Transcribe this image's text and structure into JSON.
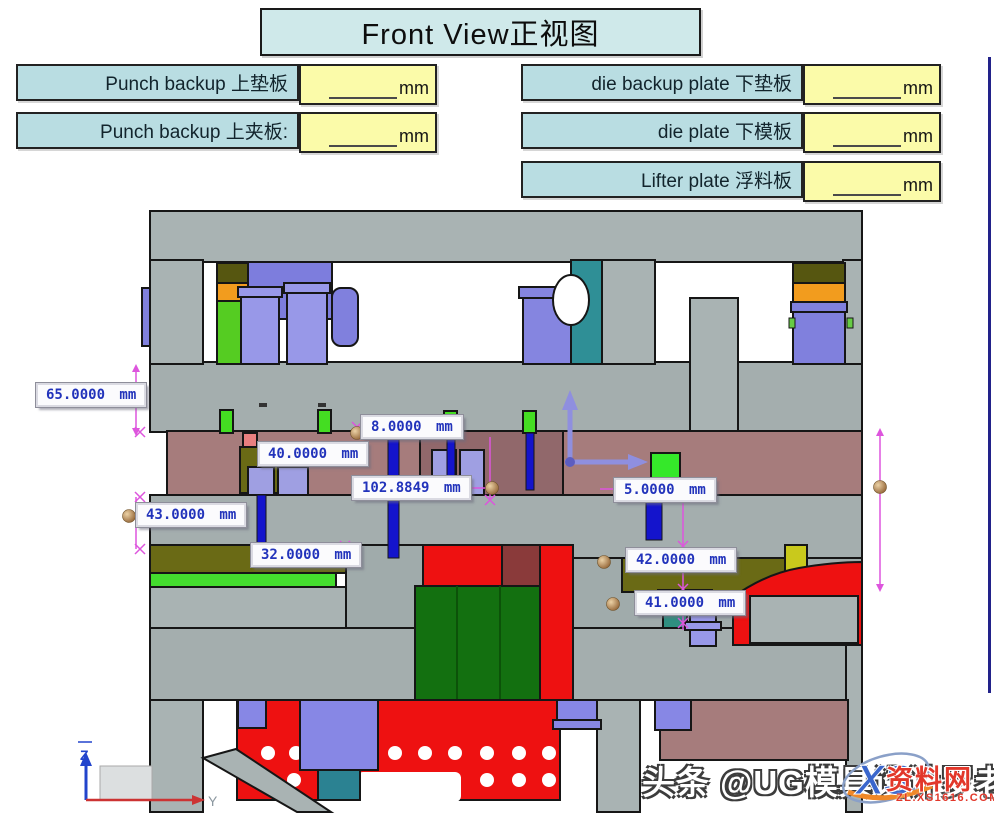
{
  "title": "Front View正视图",
  "plate_form": {
    "left": [
      {
        "label": "Punch backup 上垫板",
        "value": "",
        "unit": "mm"
      },
      {
        "label": "Punch backup 上夹板:",
        "value": "",
        "unit": "mm"
      }
    ],
    "right": [
      {
        "label": "die backup plate 下垫板",
        "value": "",
        "unit": "mm"
      },
      {
        "label": "die plate 下模板",
        "value": "",
        "unit": "mm"
      },
      {
        "label": "Lifter plate 浮料板",
        "value": "",
        "unit": "mm"
      }
    ]
  },
  "cad_view": {
    "dimensions": [
      {
        "name": "punch-backup-plate",
        "text": "65.0000 mm"
      },
      {
        "name": "insert-step",
        "text": "8.0000 mm"
      },
      {
        "name": "punch-holder-plate",
        "text": "40.0000 mm"
      },
      {
        "name": "open-height",
        "text": "102.8849 mm"
      },
      {
        "name": "clearance",
        "text": "5.0000 mm"
      },
      {
        "name": "stripper-plate",
        "text": "43.0000 mm"
      },
      {
        "name": "die-plate",
        "text": "32.0000 mm"
      },
      {
        "name": "die-backup-plate",
        "text": "42.0000 mm"
      },
      {
        "name": "lifter-plate",
        "text": "41.0000 mm"
      }
    ],
    "triad": {
      "z_label": "Z",
      "y_label": "Y"
    }
  },
  "watermark": {
    "text": "头条 @UG模具设计罗老师"
  },
  "logo": {
    "monogram": "XS",
    "site_name": "资料网",
    "site_url": "ZL.XS1616.COM"
  },
  "colors": {
    "title_bg": "#cfe9ea",
    "label_bg": "#b9dde2",
    "value_bg": "#fbfba9",
    "dim_text_blue": "#2233bb",
    "dim_line_magenta": "#dd55dd",
    "cad_gray": "#a9b3b3",
    "mauve_plate": "#a67c7c",
    "olive_plate": "#6a6a15",
    "orange_block": "#f29c1e",
    "green_bright": "#44dd2e",
    "green_dark": "#137010",
    "red_block": "#ee1111",
    "purple_screw": "#8080dd",
    "blue_pin": "#1414cc",
    "teal_block": "#2f8f96",
    "yellow_block": "#c9c91c",
    "navy_border": "#22228a",
    "logo_red": "#e2372a",
    "sphere_bronze": "#b98955"
  }
}
